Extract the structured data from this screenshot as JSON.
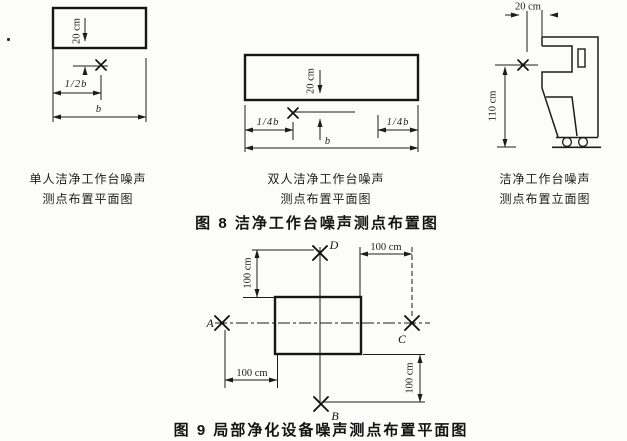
{
  "colors": {
    "ink": "#1c1c1c",
    "paper": "#fcfcfa"
  },
  "fig8": {
    "caption": "图 8  洁净工作台噪声测点布置图",
    "single": {
      "caption_line1": "单人洁净工作台噪声",
      "caption_line2": "测点布置平面图",
      "dim_offset": "20 cm",
      "dim_half_width": "1/2b",
      "dim_width": "b"
    },
    "double": {
      "caption_line1": "双人洁净工作台噪声",
      "caption_line2": "测点布置平面图",
      "dim_offset": "20 cm",
      "dim_quarter_left": "1/4b",
      "dim_quarter_right": "1/4b",
      "dim_width": "b"
    },
    "elevation": {
      "caption_line1": "洁净工作台噪声",
      "caption_line2": "测点布置立面图",
      "dim_offset": "20 cm",
      "dim_height": "110 cm"
    }
  },
  "fig9": {
    "caption": "图 9  局部净化设备噪声测点布置平面图",
    "point_a": "A",
    "point_b": "B",
    "point_c": "C",
    "point_d": "D",
    "dim_top_left": "100 cm",
    "dim_top_right": "100 cm",
    "dim_bottom_left": "100 cm",
    "dim_bottom_right": "100 cm"
  }
}
